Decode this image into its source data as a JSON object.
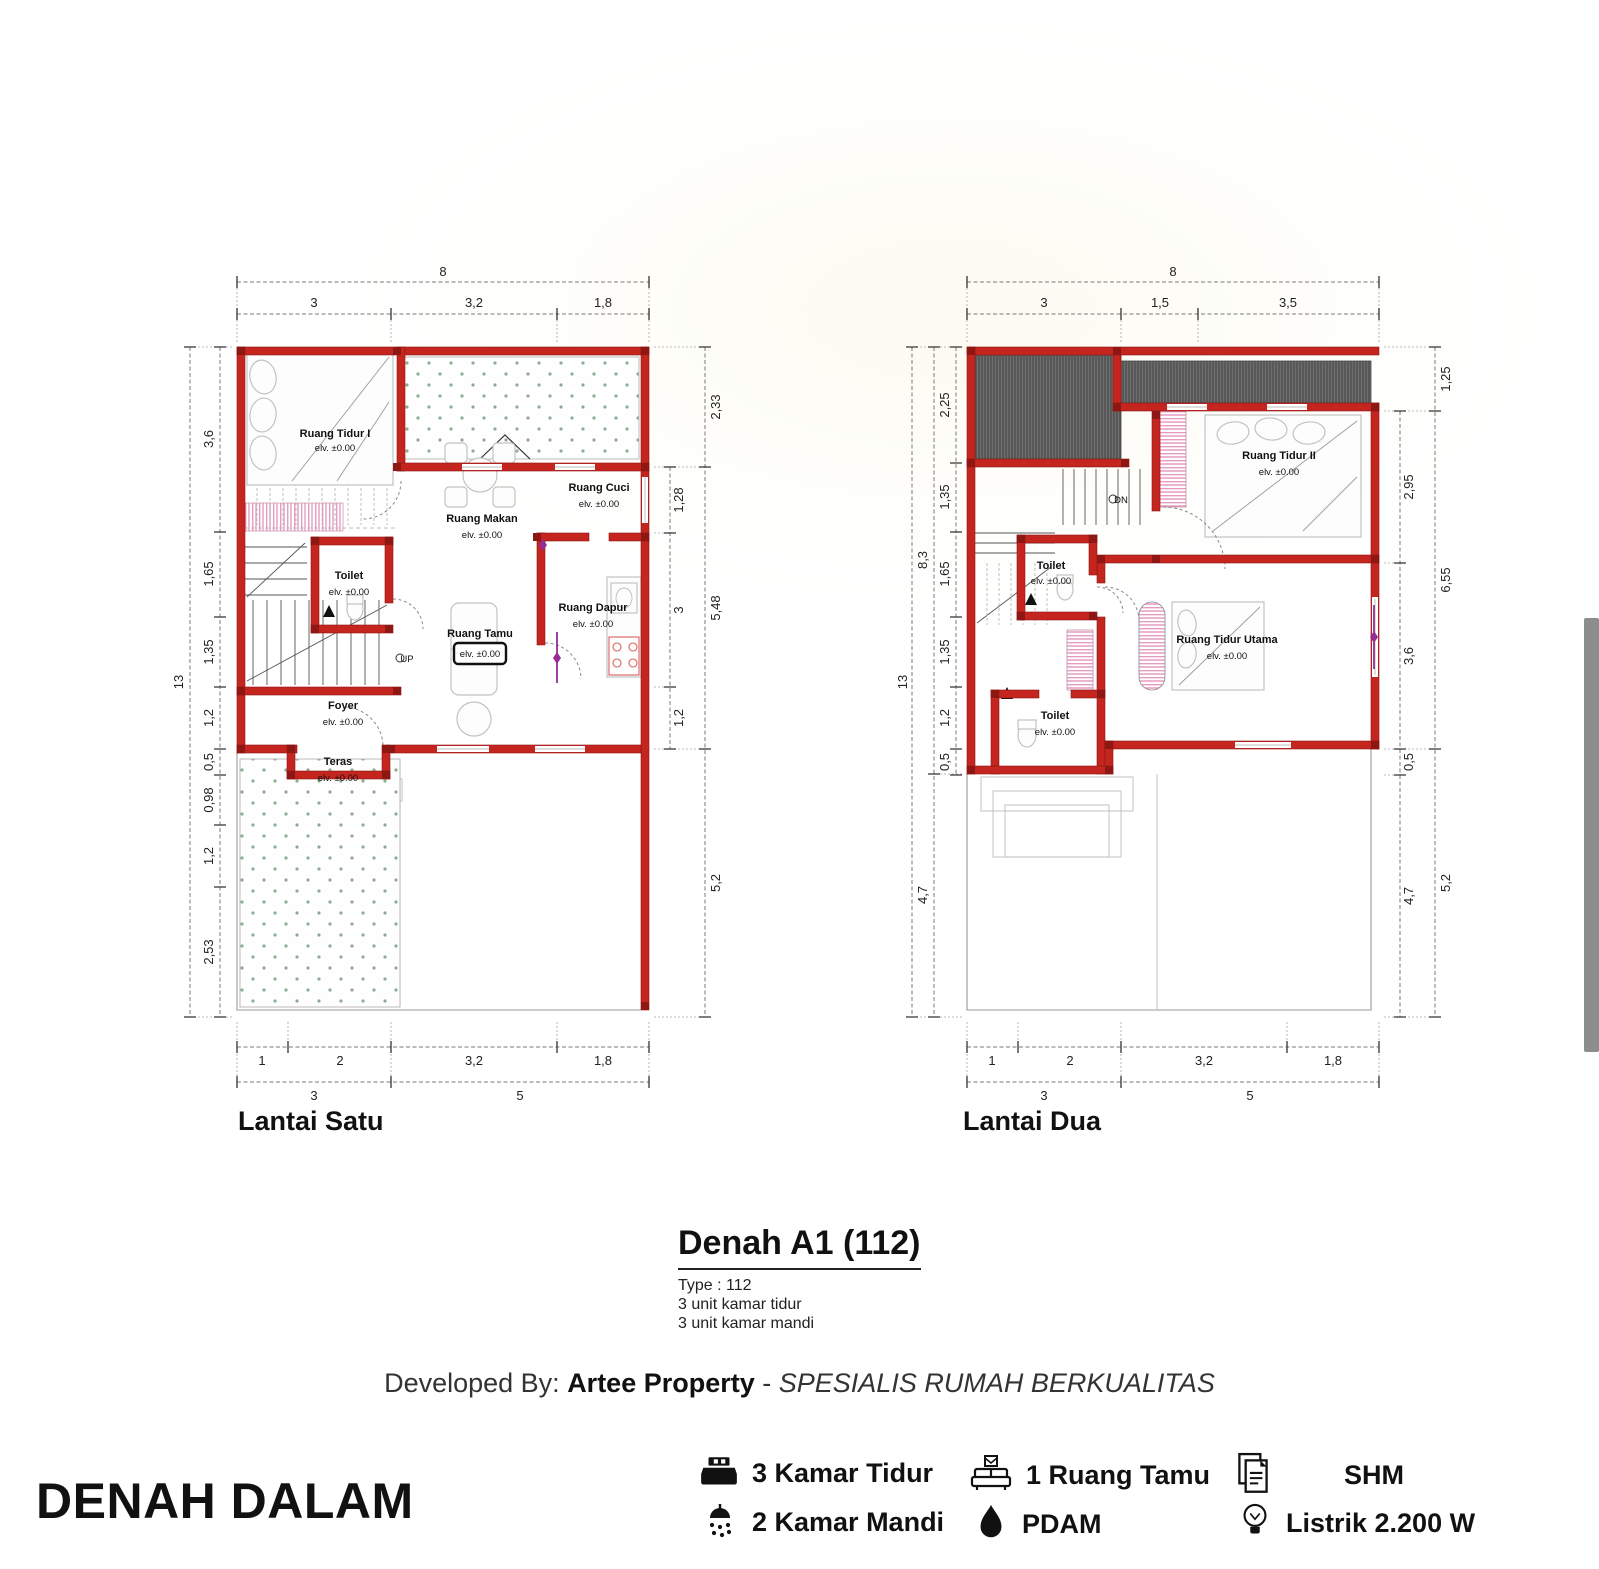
{
  "floor1": {
    "title": "Lantai Satu",
    "stair_label": "UP",
    "dims": {
      "top_total": "8",
      "top_segs": [
        "3",
        "3,2",
        "1,8"
      ],
      "left_total": "13",
      "left_segs": [
        "3,6",
        "1,65",
        "1,35",
        "1,2",
        "0,5",
        "0,98",
        "1,2",
        "2,53"
      ],
      "right_inner": [
        "1,28",
        "3",
        "1,2"
      ],
      "right_outer": [
        "2,33",
        "5,48",
        "5,2"
      ],
      "bottom_segs": [
        "1",
        "2",
        "3,2",
        "1,8"
      ],
      "bottom_groups": [
        "3",
        "5"
      ]
    },
    "rooms": {
      "tidur": {
        "name": "Ruang Tidur I",
        "elev": "elv. ±0.00"
      },
      "makan": {
        "name": "Ruang Makan",
        "elev": "elv. ±0.00"
      },
      "cuci": {
        "name": "Ruang Cuci",
        "elev": "elv. ±0.00"
      },
      "toilet": {
        "name": "Toilet",
        "elev": "elv. ±0.00"
      },
      "dapur": {
        "name": "Ruang Dapur",
        "elev": "elv. ±0.00"
      },
      "tamu": {
        "name": "Ruang Tamu",
        "elev": "elv. ±0.00"
      },
      "foyer": {
        "name": "Foyer",
        "elev": "elv. ±0.00"
      },
      "teras": {
        "name": "Teras",
        "elev": "elv. ±0.00"
      }
    }
  },
  "floor2": {
    "title": "Lantai Dua",
    "stair_label": "DN",
    "dims": {
      "top_total": "8",
      "top_segs": [
        "3",
        "1,5",
        "3,5"
      ],
      "left_total": "13",
      "left_mid": [
        "8,3",
        "4,7"
      ],
      "left_segs": [
        "2,25",
        "1,35",
        "1,65",
        "1,35",
        "1,2",
        "0,5"
      ],
      "right_inner": [
        "2,95",
        "3,6",
        "0,5",
        "4,7"
      ],
      "right_outer": [
        "1,25",
        "6,55",
        "5,2"
      ],
      "bottom_segs": [
        "1",
        "2",
        "3,2",
        "1,8"
      ],
      "bottom_groups": [
        "3",
        "5"
      ]
    },
    "rooms": {
      "tidur2": {
        "name": "Ruang Tidur II",
        "elev": "elv. ±0.00"
      },
      "toilet_atas": {
        "name": "Toilet",
        "elev": "elv. ±0.00"
      },
      "utama": {
        "name": "Ruang Tidur Utama",
        "elev": "elv. ±0.00"
      },
      "toilet_bawah": {
        "name": "Toilet",
        "elev": "elv. ±0.00"
      }
    }
  },
  "title_block": {
    "title": "Denah A1 (112)",
    "type_line": "Type : 112",
    "bedrooms_line": "3 unit kamar tidur",
    "bathrooms_line": "3 unit kamar mandi"
  },
  "developer_line": {
    "prefix": "Developed By: ",
    "brand": "Artee Property",
    "separator": " - ",
    "tagline": "SPESIALIS RUMAH BERKUALITAS"
  },
  "section_label": "DENAH DALAM",
  "features": {
    "col1": [
      {
        "icon": "bed-icon",
        "label": "3 Kamar Tidur"
      },
      {
        "icon": "shower-icon",
        "label": "2 Kamar Mandi"
      }
    ],
    "col2": [
      {
        "icon": "sofa-icon",
        "label": "1 Ruang Tamu"
      },
      {
        "icon": "water-drop-icon",
        "label": "PDAM"
      }
    ],
    "col3": [
      {
        "icon": "certificate-icon",
        "label": "SHM"
      },
      {
        "icon": "bulb-icon",
        "label": "Listrik 2.200 W"
      }
    ]
  },
  "colors": {
    "wall_red": "#c4251f",
    "wall_dark": "#8e1713",
    "green_dots": "#8fae8f",
    "pink_hatch": "#e59cc0",
    "roof_gray": "#585858",
    "window_marker_purple": "#952d95",
    "text_black": "#111111"
  }
}
